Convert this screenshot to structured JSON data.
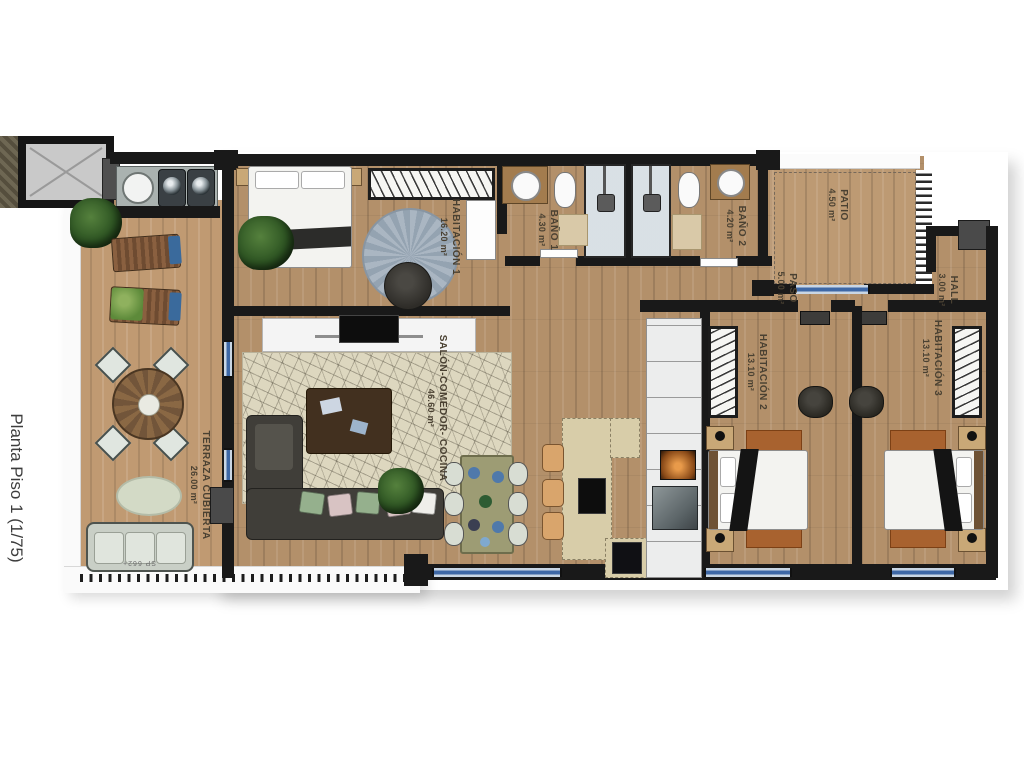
{
  "title": "Planta Piso 1 (1/75)",
  "rooms": {
    "terraza": {
      "name": "TERRAZA CUBIERTA",
      "area": "26.00 m²"
    },
    "habitacion1": {
      "name": "HABITACIÓN 1",
      "area": "16.20 m²"
    },
    "bano1": {
      "name": "BAÑO 1",
      "area": "4.30 m²"
    },
    "bano2": {
      "name": "BAÑO 2",
      "area": "4.20 m²"
    },
    "patio": {
      "name": "PATIO",
      "area": "4.50 m²"
    },
    "paso": {
      "name": "PASO",
      "area": "5.00 m²"
    },
    "hall": {
      "name": "HALL",
      "area": "3.00 m²"
    },
    "habitacion2": {
      "name": "HABITACIÓN 2",
      "area": "13.10 m²"
    },
    "habitacion3": {
      "name": "HABITACIÓN 3",
      "area": "13.10 m²"
    },
    "salon": {
      "name": "SALÓN-COMEDOR- COCINA",
      "area": "46.60 m²"
    }
  },
  "annotations": {
    "level_mark": "SP 662+"
  },
  "colors": {
    "wall": "#191919",
    "wood": "#b3906a",
    "terrace_wood": "#c09a72",
    "window_glass": "#3e68a6",
    "salon_rug": "#ddd7bf",
    "island": "#d8cda9",
    "pillow_green": "#95b08d",
    "pillow_pink": "#d8c3c3",
    "bedroom_rug": "#a8622f"
  }
}
